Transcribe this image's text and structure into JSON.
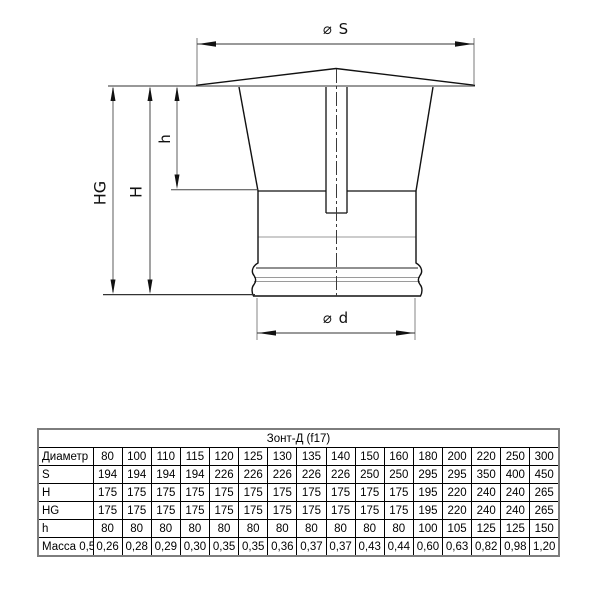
{
  "diagram": {
    "dim_s_label": "⌀ S",
    "dim_d_label": "⌀ d",
    "dim_hg_label": "HG",
    "dim_h_label": "H",
    "dim_h_small_label": "h"
  },
  "table": {
    "title": "Зонт-Д (f17)",
    "rows": [
      {
        "label": "Диаметр",
        "values": [
          "80",
          "100",
          "110",
          "115",
          "120",
          "125",
          "130",
          "135",
          "140",
          "150",
          "160",
          "180",
          "200",
          "220",
          "250",
          "300"
        ]
      },
      {
        "label": "S",
        "values": [
          "194",
          "194",
          "194",
          "194",
          "226",
          "226",
          "226",
          "226",
          "226",
          "250",
          "250",
          "295",
          "295",
          "350",
          "400",
          "450"
        ]
      },
      {
        "label": "H",
        "values": [
          "175",
          "175",
          "175",
          "175",
          "175",
          "175",
          "175",
          "175",
          "175",
          "175",
          "175",
          "195",
          "220",
          "240",
          "240",
          "265"
        ]
      },
      {
        "label": "HG",
        "values": [
          "175",
          "175",
          "175",
          "175",
          "175",
          "175",
          "175",
          "175",
          "175",
          "175",
          "175",
          "195",
          "220",
          "240",
          "240",
          "265"
        ]
      },
      {
        "label": "h",
        "values": [
          "80",
          "80",
          "80",
          "80",
          "80",
          "80",
          "80",
          "80",
          "80",
          "80",
          "80",
          "100",
          "105",
          "125",
          "125",
          "150"
        ]
      },
      {
        "label": "Масса 0,5",
        "values": [
          "0,26",
          "0,28",
          "0,29",
          "0,30",
          "0,35",
          "0,35",
          "0,36",
          "0,37",
          "0,37",
          "0,43",
          "0,44",
          "0,60",
          "0,63",
          "0,82",
          "0,98",
          "1,20"
        ]
      }
    ]
  }
}
